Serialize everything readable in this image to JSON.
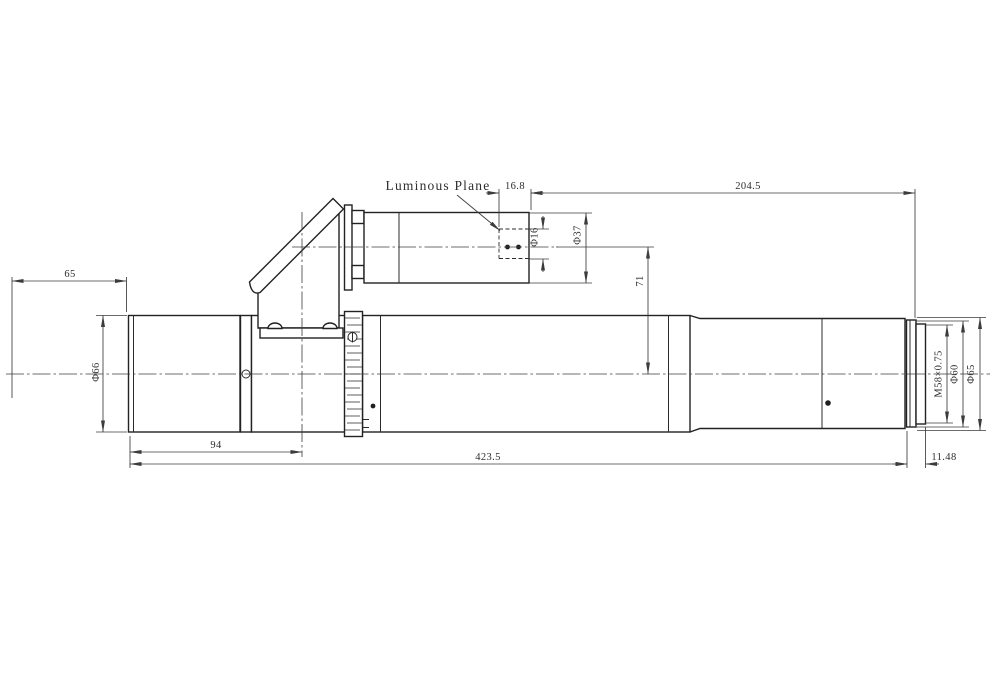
{
  "drawing": {
    "annotation": {
      "luminous_plane": "Luminous Plane"
    },
    "dims": {
      "front_standoff": "65",
      "front_barrel_dia": "Φ66",
      "image_plane_inset": "16.8",
      "rear_section_length": "204.5",
      "image_circle_dia": "Φ16",
      "eyepiece_tube_dia": "Φ37",
      "axis_offset": "71",
      "front_to_prism_axis": "94",
      "body_length": "423.5",
      "thread_length": "11.48",
      "mount_thread": "M58×0.75",
      "thread_shoulder_dia": "Φ60",
      "rear_barrel_dia": "Φ65"
    },
    "colors": {
      "line": "#2b2b2b",
      "thin_line": "#3c3c3c",
      "background": "#ffffff"
    }
  }
}
